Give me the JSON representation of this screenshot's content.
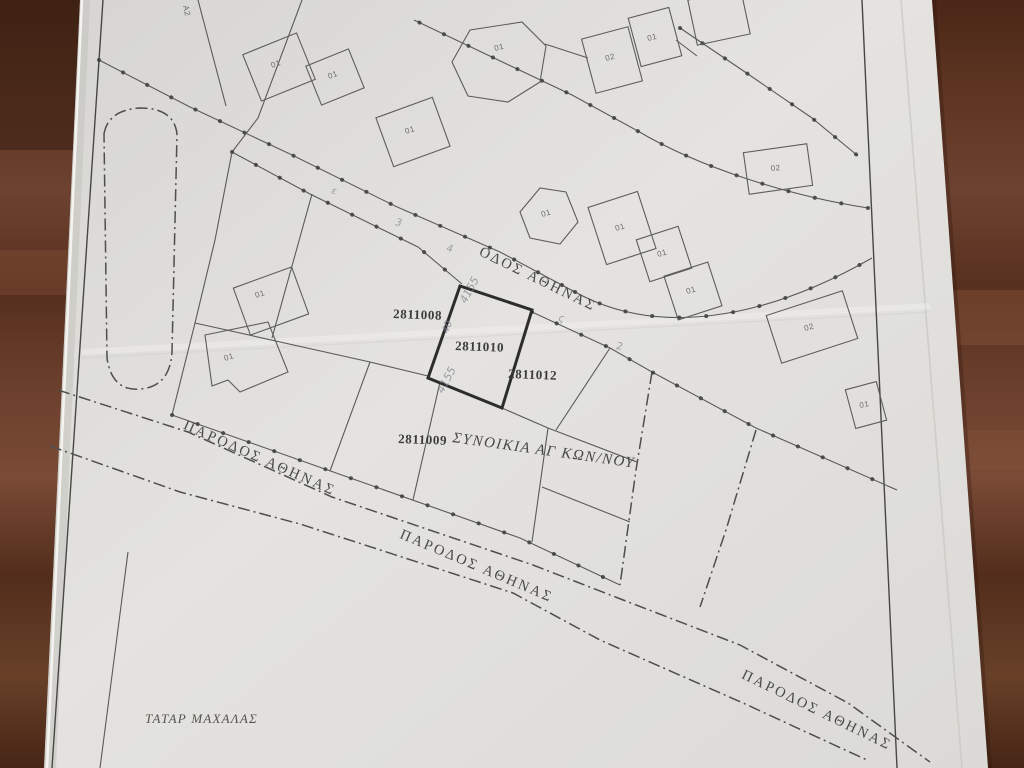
{
  "map": {
    "streets": [
      {
        "id": "odos-athinas",
        "label": "ΟΔΟΣ ΑΘΗΝΑΣ"
      },
      {
        "id": "parodos-athinas-left",
        "label": "ΠΑΡΟΔΟΣ ΑΘΗΝΑΣ"
      },
      {
        "id": "parodos-athinas-middle",
        "label": "ΠΑΡΟΔΟΣ ΑΘΗΝΑΣ"
      },
      {
        "id": "parodos-athinas-right",
        "label": "ΠΑΡΟΔΟΣ ΑΘΗΝΑΣ"
      }
    ],
    "district_label": "ΣΥΝΟΙΚΙΑ ΑΓ ΚΩΝ/ΝΟΥ",
    "area_label": "ΤΑΤΑΡ ΜΑΧΑΛΑΣ",
    "edge_label": "Α2",
    "parcels": [
      {
        "number": "2811008",
        "highlighted": false
      },
      {
        "number": "2811010",
        "highlighted": true
      },
      {
        "number": "2811012",
        "highlighted": false
      },
      {
        "number": "2811009",
        "highlighted": false
      }
    ],
    "building_labels": [
      "01",
      "01",
      "01",
      "01",
      "02",
      "01",
      "01",
      "01",
      "01",
      "01",
      "02",
      "02",
      "01",
      "01",
      "01"
    ],
    "handwritten": [
      "4155",
      "40",
      "4155",
      "ε",
      "3",
      "4",
      "ς",
      "2"
    ],
    "colors": {
      "paper": "#e0dfdb",
      "ink": "#4a4a4a",
      "highlight_outline": "#2d2d2b",
      "wood_dark": "#4a2717",
      "wood_light": "#7a4b36",
      "pencil": "#80848f"
    }
  }
}
